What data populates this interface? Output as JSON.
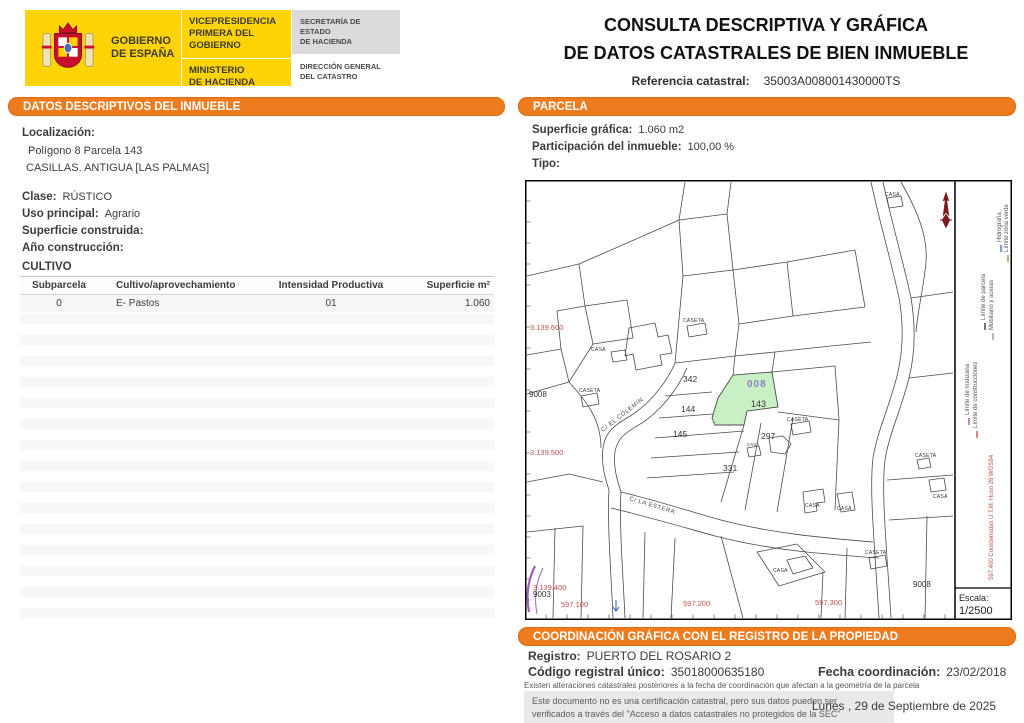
{
  "header": {
    "title_line1": "CONSULTA DESCRIPTIVA Y GRÁFICA",
    "title_line2": "DE DATOS CATASTRALES DE BIEN INMUEBLE",
    "ref_label": "Referencia catastral:",
    "ref_value": "35003A008001430000TS",
    "logo": {
      "gobierno": "GOBIERNO\nDE ESPAÑA",
      "vicepresidencia": "VICEPRESIDENCIA\nPRIMERA DEL GOBIERNO",
      "ministerio": "MINISTERIO\nDE HACIENDA",
      "secretaria": "SECRETARÍA DE ESTADO\nDE HACIENDA",
      "direccion": "DIRECCIÓN GENERAL\nDEL CATASTRO"
    }
  },
  "datos": {
    "section_title": "DATOS DESCRIPTIVOS DEL INMUEBLE",
    "localizacion_label": "Localización:",
    "localizacion_line1": "Polígono 8 Parcela 143",
    "localizacion_line2": "CASILLAS. ANTIGUA [LAS PALMAS]",
    "clase_label": "Clase:",
    "clase_value": "RÚSTICO",
    "uso_label": "Uso principal:",
    "uso_value": "Agrario",
    "superficie_label": "Superficie construida:",
    "superficie_value": "",
    "anio_label": "Año construcción:",
    "anio_value": "",
    "cultivo_title": "CULTIVO",
    "cultivo_table": {
      "headers": [
        "Subparcela",
        "Cultivo/aprovechamiento",
        "Intensidad Productiva",
        "Superficie m²"
      ],
      "rows": [
        [
          "0",
          "E- Pastos",
          "01",
          "1.060"
        ]
      ]
    }
  },
  "parcela": {
    "section_title": "PARCELA",
    "superficie_label": "Superficie gráfica:",
    "superficie_value": "1.060 m2",
    "participacion_label": "Participación del inmueble:",
    "participacion_value": "100,00 %",
    "tipo_label": "Tipo:",
    "tipo_value": ""
  },
  "map": {
    "parcels": {
      "p342": "342",
      "p144": "144",
      "p145": "145",
      "p297": "297",
      "p331": "331",
      "highlight_code": "008",
      "highlight_number": "143",
      "id9008": "9008",
      "id9003": "9003"
    },
    "buildings": {
      "casa": "CASA",
      "caseta": "CASETA"
    },
    "coords": {
      "y1": "3.139.600",
      "y2": "3.139.500",
      "y3": "3.139.400",
      "x1": "597.100",
      "x2": "597.200",
      "x3": "597.300"
    },
    "streets": {
      "s1": "C/ EL COLEMIN",
      "s2": "C/ LA ESTERA"
    },
    "legend": {
      "items": [
        {
          "label": "Límite de manzana",
          "color": "#A05FB5"
        },
        {
          "label": "Límite de construcciones",
          "color": "#C0524E"
        },
        {
          "label": "Límite de parcela",
          "color": "#3a3a3a"
        },
        {
          "label": "Mobiliario y aceras",
          "color": "#9a9a9a"
        },
        {
          "label": "Hidrografía",
          "color": "#4472C4"
        },
        {
          "label": "Límite zona verde",
          "color": "#6FAF46"
        }
      ],
      "utm": "597.400 Coordenadas U.T.M. Huso 28 WGS84"
    },
    "escala_label": "Escala:",
    "escala_value": "1/2500"
  },
  "coordinacion": {
    "section_title": "COORDINACIÓN GRÁFICA CON EL REGISTRO DE LA PROPIEDAD",
    "registro_label": "Registro:",
    "registro_value": "PUERTO DEL ROSARIO 2",
    "codigo_label": "Código registral único:",
    "codigo_value": "35018000635180",
    "fecha_label": "Fecha coordinación:",
    "fecha_value": "23/02/2018",
    "alteraciones": "Existen alteraciones catastrales posteriores a la fecha de coordinación que afectan a la geometría de la parcela",
    "aviso_line1": "Este documento no es una certificación catastral, pero sus datos pueden ser",
    "aviso_line2": "verificados a través del \"Acceso a datos catastrales no protegidos de la SEC\"",
    "fecha_documento": "Lunes , 29 de Septiembre de 2025"
  }
}
